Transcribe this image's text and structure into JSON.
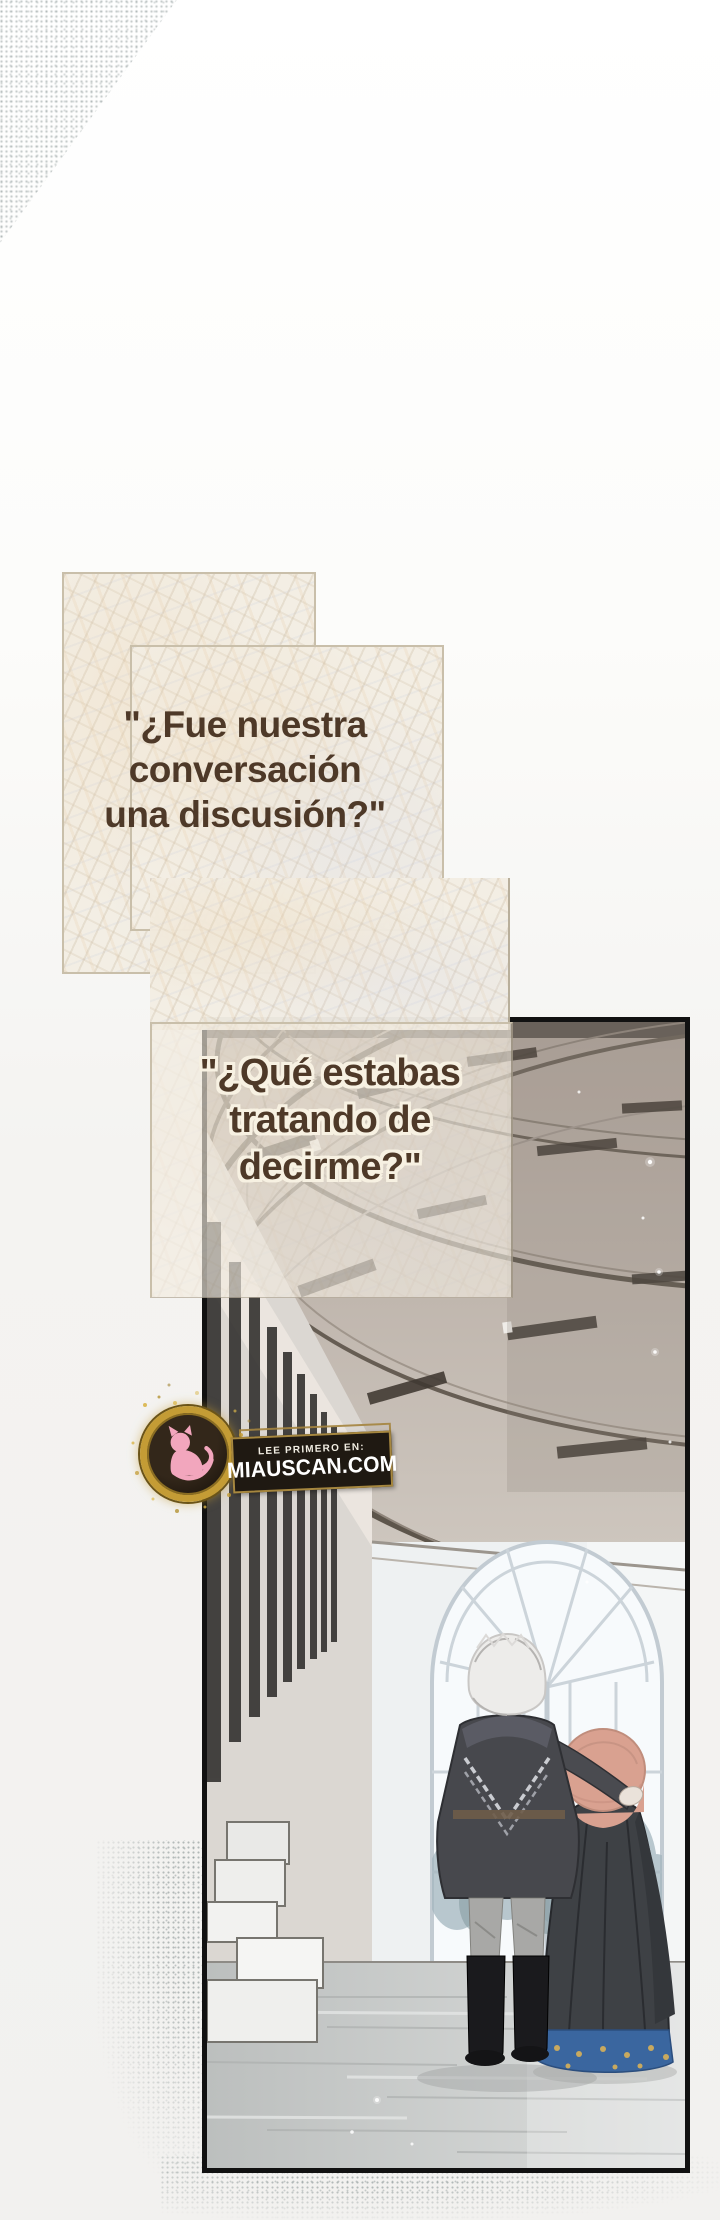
{
  "speech_bubbles": [
    {
      "lines": [
        "\"¿Fue nuestra",
        "conversación",
        "una discusión?\""
      ]
    },
    {
      "lines": [
        "\"¿Qué estabas",
        "tratando de",
        "decirme?\""
      ]
    }
  ],
  "watermark": {
    "tagline": "LEE PRIMERO EN:",
    "site": "MIAUSCAN.COM"
  },
  "colors": {
    "speech_text": "#4e3928",
    "panel_cream": "#f3eee4",
    "panel_border": "#c9bfaa",
    "art_border": "#111111",
    "watermark_gold": "#c49c35",
    "watermark_pink": "#f2a6bd",
    "banner_bg": "#1f1912",
    "banner_text": "#ffffff",
    "hair_pink": "#d9a190",
    "dress_blue": "#3a669f"
  }
}
